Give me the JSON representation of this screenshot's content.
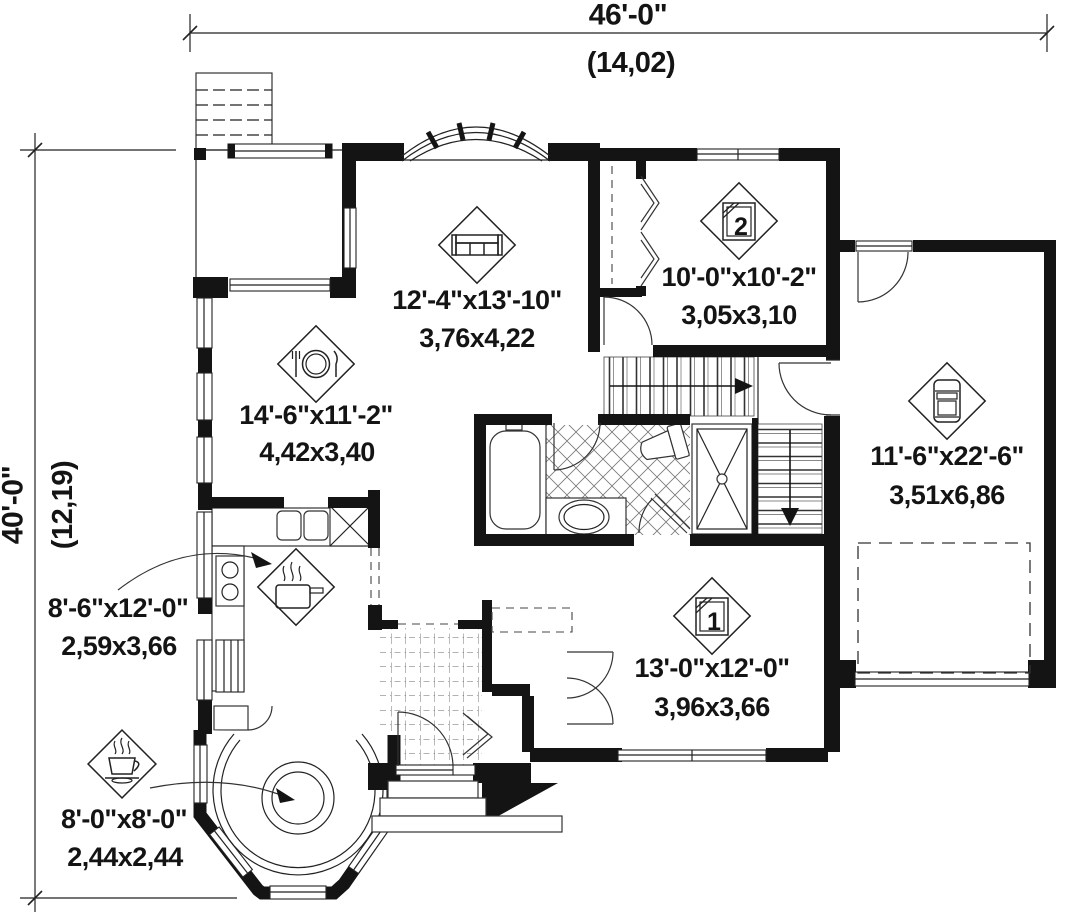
{
  "drawing": {
    "type": "house-floor-plan",
    "colors": {
      "ink": "#141414",
      "paper": "#ffffff"
    },
    "dimensions": {
      "top": {
        "feet": "46'-0\"",
        "meters": "(14,02)"
      },
      "left": {
        "feet": "40'-0\"",
        "meters": "(12,19)"
      }
    },
    "rooms": {
      "living": {
        "imperial": "12'-4\"x13'-10\"",
        "metric": "3,76x4,22",
        "icon": "sofa-icon"
      },
      "bedroom2": {
        "imperial": "10'-0\"x10'-2\"",
        "metric": "3,05x3,10",
        "icon": "bed-icon",
        "number": "2"
      },
      "dining": {
        "imperial": "14'-6\"x11'-2\"",
        "metric": "4,42x3,40",
        "icon": "dining-plate-icon"
      },
      "garage": {
        "imperial": "11'-6\"x22'-6\"",
        "metric": "3,51x6,86",
        "icon": "car-icon"
      },
      "kitchen": {
        "imperial": "8'-6\"x12'-0\"",
        "metric": "2,59x3,66",
        "icon": "cooking-pot-icon"
      },
      "bedroom1": {
        "imperial": "13'-0\"x12'-0\"",
        "metric": "3,96x3,66",
        "icon": "bed-icon",
        "number": "1"
      },
      "breakfast": {
        "imperial": "8'-0\"x8'-0\"",
        "metric": "2,44x2,44",
        "icon": "coffee-cup-icon"
      }
    }
  }
}
